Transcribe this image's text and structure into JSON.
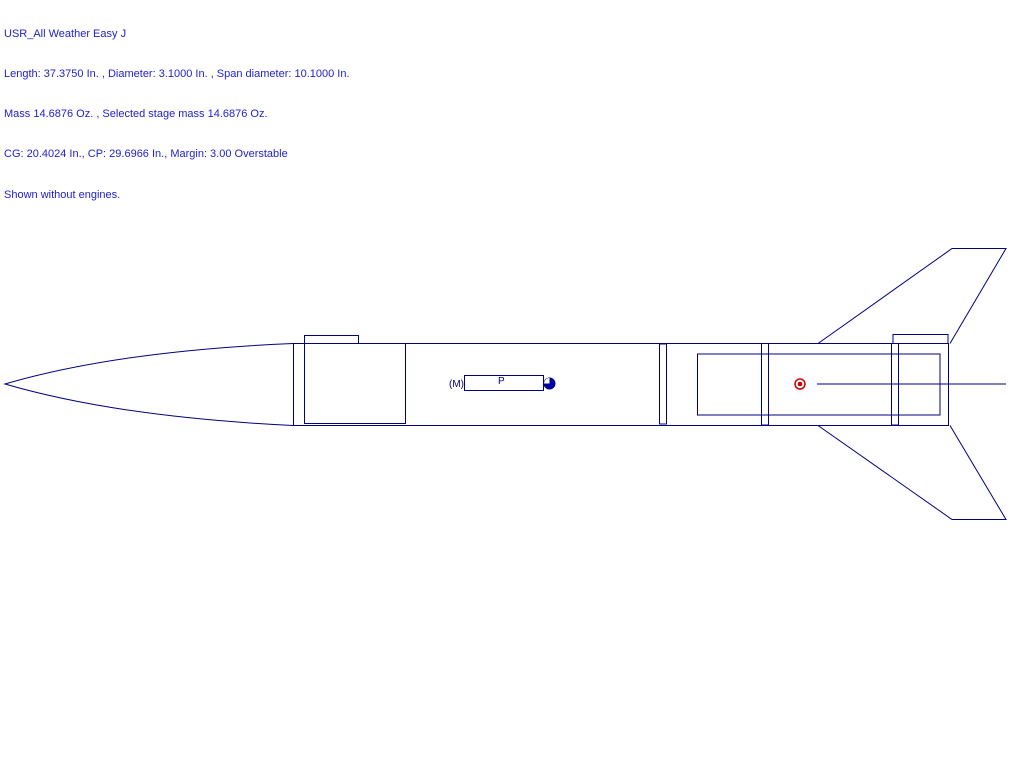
{
  "header": {
    "lines": [
      "USR_All Weather Easy J",
      "Length: 37.3750 In. , Diameter: 3.1000 In. , Span diameter: 10.1000 In.",
      "Mass 14.6876 Oz. , Selected stage mass 14.6876 Oz.",
      "CG: 20.4024 In., CP: 29.6966 In., Margin: 3.00 Overstable",
      "Shown without engines."
    ]
  },
  "labels": {
    "mass_object": "(M)",
    "parachute": "P"
  },
  "colors": {
    "outline": "#000080",
    "header_text": "#2121CE",
    "cg_marker_fill": "#0000A8",
    "cp_marker": "#CC0000",
    "background": "#FFFFFF"
  }
}
